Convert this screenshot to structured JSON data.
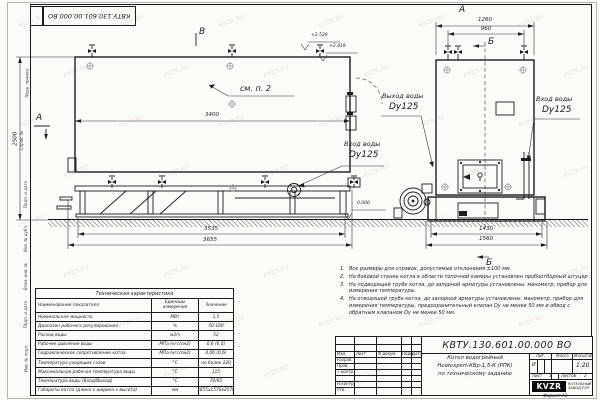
{
  "sheet": {
    "stamp_number": "КВТУ.130.601.00.000  ВО",
    "format_label": "Формат  А3",
    "watermark": "KVZR.RU",
    "margin_labels": [
      "Перв. примен.",
      "Справ. №",
      "Подп. и дата",
      "Инв. № дубл.",
      "Взам. инв. №",
      "Подп. и дата",
      "Инв. № подл."
    ]
  },
  "drawing": {
    "view_labels": {
      "front_top": "А",
      "side_left": "А",
      "section_top": "Б",
      "section_bottom": "Б",
      "section_side": "В"
    },
    "note_ref": "см. п. 2",
    "elevations": {
      "e1": "+2.539",
      "e2": "+2.419",
      "ground": "0.000"
    },
    "ports": {
      "side_inlet": {
        "name": "Вход воды",
        "dn": "Dy125"
      },
      "front_outlet": {
        "name": "Выход воды",
        "dn": "Dy125"
      },
      "front_inlet": {
        "name": "Вход воды",
        "dn": "Dy125"
      }
    },
    "dims": {
      "side_length": "3400",
      "side_height": "2500",
      "side_base": "3535",
      "side_total": "3655",
      "front_width": "1260",
      "front_valves": "960",
      "front_base": "1430",
      "front_total": "1560"
    }
  },
  "spec_table": {
    "title": "Техническая характеристика",
    "col_name": "Наименование показателя",
    "col_units": "Единицы измерения",
    "col_value": "Значение",
    "rows": [
      {
        "name": "Номинальная мощность",
        "units": "МВт",
        "value": "1,5"
      },
      {
        "name": "Диапазон рабочего регулирования",
        "units": "%",
        "value": "50-100"
      },
      {
        "name": "Расход воды",
        "units": "м3/ч",
        "value": "52"
      },
      {
        "name": "Рабочее давление воды",
        "units": "МПа (кгс/см2)",
        "value": "0,6 (6,0)"
      },
      {
        "name": "Гидравлическое сопротивление котла",
        "units": "МПа (кгс/см2)",
        "value": "0,06 (0,6)"
      },
      {
        "name": "Температура уходящих газов",
        "units": "°С",
        "value": "не более 220"
      },
      {
        "name": "Максимальная рабочая температура воды",
        "units": "°С",
        "value": "115"
      },
      {
        "name": "Температура воды (Вход/Выход)",
        "units": "°С",
        "value": "70/95"
      },
      {
        "name": "Габариты котла (длина х ширина х высота)",
        "units": "мм",
        "value": "3655х1570х2570"
      }
    ]
  },
  "notes": {
    "items": [
      {
        "num": "1.",
        "text": "Все размеры для справок, допустимые отклонения ±100 мм."
      },
      {
        "num": "2.",
        "text": "На боковой стенке котла в области топочной камеры установлен пробоотборный штуцер"
      },
      {
        "num": "3.",
        "text": "На подводящей трубе котла, до запорной арматуры установлены: манометр, прибор для измерения температуры."
      },
      {
        "num": "4.",
        "text": "На отводящей трубе котла, до запорной арматуры установлены: манометр, прибор для измерения температуры, предохранительный клапан Dу не менее 50 мм и обвод с обратным клапаном Dу не менее 50 мм."
      }
    ]
  },
  "titleblock": {
    "doc_number": "КВТУ.130.601.00.000  ВО",
    "title_line1": "Котел водогрейный",
    "title_line2": "Heatexpert-КВр-1,5-К (РПК)",
    "title_line3": "по техническому заданию",
    "col_izm": "Изм.",
    "col_list": "Лист",
    "col_ndoc": "N докум.",
    "col_podp": "Подп.",
    "col_data": "Дата",
    "row_razrab": "Разраб.",
    "row_prov": "Пров.",
    "row_tkontr": "Т.контр.",
    "row_nkontr": "Н.контр.",
    "row_utv": "Утв.",
    "lit_label": "Лит.",
    "lit_value": "И",
    "mass_label": "Масса",
    "scale_label": "Масштаб",
    "scale_value": "1:20",
    "sheet_label": "Лист",
    "sheet_value": "1",
    "sheets_label": "Листов",
    "sheets_value": "2",
    "logo": "KVZR",
    "company_line1": "КОТЕЛЬНЫЙ",
    "company_line2": "ЗАВОД РЭП"
  }
}
